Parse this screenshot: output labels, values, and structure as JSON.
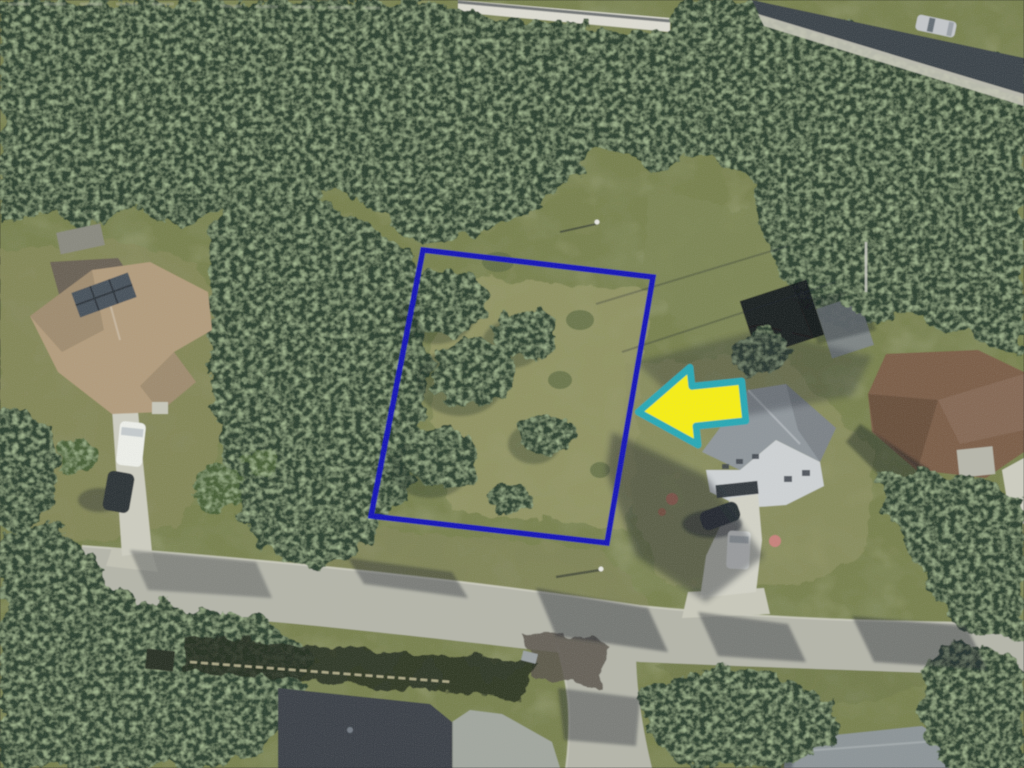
{
  "meta": {
    "type": "aerial-photograph",
    "description": "Overhead aerial photo of a suburban neighborhood: a wooded vacant parcel outlined in blue with a large yellow arrow pointing left at it, surrounded by houses, driveways, streets and dense tree canopy."
  },
  "annotations": {
    "parcel_outline": {
      "label": "highlighted vacant lot boundary",
      "shape": "quadrilateral",
      "color": "#1414b8"
    },
    "arrow": {
      "label": "callout arrow pointing at the parcel",
      "direction": "left",
      "fill": "#f6ee13",
      "outline": "#2ba8b4"
    }
  },
  "palette": {
    "grass": "#78814f",
    "dry_grass": "#969869",
    "scrub": "#5d6b44",
    "canopy": "#2d4330",
    "canopy_light": "#4a6138",
    "asphalt": "#b5b6aa",
    "asphalt_patch": "#5a554e",
    "shadow_road": "#3d444c",
    "concrete": "#cdcdc0",
    "wall": "#dddcd2"
  },
  "houses": {
    "left_roof": "#b29c7d",
    "left_back_roof": "#6a6256",
    "solar_panels": "#49525b",
    "shed_left": "#8a8a80",
    "right_roof": "#8f969b",
    "right_walls": "#ced2d4",
    "garage_door": "#343b40",
    "east_roof": "#7c5f49",
    "east_carport": "#b7b7ab",
    "bottom_roof": "#3c4349",
    "bottom_roof_light": "#a2a79f",
    "bottom_right_roof": "#8d9598",
    "shed_dark": "#14181c",
    "shed_gray": "#7e8588"
  },
  "vehicles": {
    "van_left": "#edefe9",
    "suv_left": "#2e3538",
    "suv_right": "#2b3236",
    "van_right": "#f0f2ee",
    "car_top_right": "#c3c6c9",
    "bin_gray": "#9aa0a2"
  },
  "objects": [
    {
      "name": "highlighted-vacant-lot",
      "label": "Vacant scrub-covered lot outlined in blue"
    },
    {
      "name": "direction-arrow",
      "label": "Yellow arrow with teal outline pointing left at the lot"
    },
    {
      "name": "left-house",
      "label": "House with tan hip roof, solar panels, white van and dark SUV in driveway"
    },
    {
      "name": "right-house",
      "label": "Two-story gray house with garage, white van and dark SUV in driveway"
    },
    {
      "name": "east-house",
      "label": "Brown-roof house at right edge"
    },
    {
      "name": "bottom-house",
      "label": "Dark-roof house at bottom center with fenced backyard"
    },
    {
      "name": "bottom-right-house",
      "label": "Gray roof at bottom right corner"
    },
    {
      "name": "main-street",
      "label": "Residential street crossing the lower third"
    },
    {
      "name": "side-street",
      "label": "Side street branching toward bottom edge"
    },
    {
      "name": "upper-road",
      "label": "Shaded road with silver car at top right"
    },
    {
      "name": "white-wall",
      "label": "Long white wall along the top"
    },
    {
      "name": "tree-canopy",
      "label": "Dense tree canopy surrounding the properties"
    },
    {
      "name": "utility-poles",
      "label": "Utility poles with long shadows"
    }
  ]
}
